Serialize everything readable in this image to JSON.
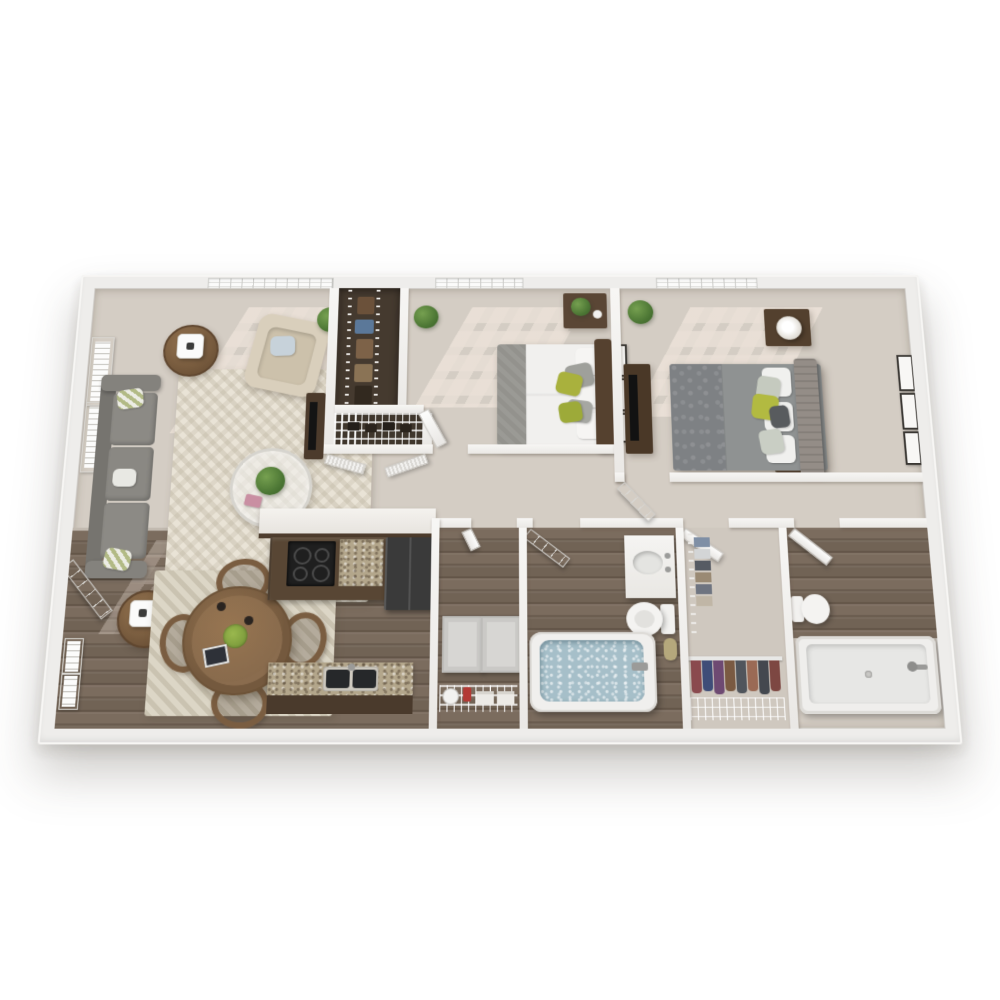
{
  "image": {
    "kind": "3d-floor-plan-render",
    "title": "Two bedroom two bath apartment 3D floor plan",
    "background": "#ffffff"
  },
  "palette": {
    "wall_white": "#f3f2f0",
    "carpet": "#d3ccc3",
    "hardwood": "#75675a",
    "rug_cream": "#e9e3d6",
    "sofa_gray": "#85837f",
    "armchair_cream": "#d9cfbc",
    "accent_green": "#a9b13d",
    "dark_wood": "#55412f",
    "cabinet_brown": "#584634",
    "granite_tan": "#b3a68b",
    "tub_water": "#a6bfc9",
    "appliance_black": "#1f1f1f"
  },
  "apartment": {
    "label": "2 Bedroom / 2 Bath",
    "rooms": [
      {
        "id": "living-room",
        "name": "Living Room",
        "floor": "carpet",
        "furniture": [
          "gray sofa with green pillows",
          "two cream armchairs",
          "round glass coffee table with plant",
          "two round wood side tables with lamps",
          "chevron area rug",
          "tv console",
          "wall art",
          "window"
        ]
      },
      {
        "id": "dining-area",
        "name": "Dining Area",
        "floor": "hardwood",
        "furniture": [
          "round wood dining table",
          "four wood chairs",
          "cream rug",
          "fruit bowl",
          "tablet",
          "entry door",
          "wall art"
        ]
      },
      {
        "id": "kitchen",
        "name": "Kitchen",
        "floor": "hardwood",
        "furniture": [
          "breakfast bar counter",
          "dark brown cabinets",
          "black range",
          "granite countertop",
          "refrigerator",
          "peninsula with double sink"
        ]
      },
      {
        "id": "hallway",
        "name": "Hallway",
        "floor": "carpet",
        "furniture": []
      },
      {
        "id": "long-closet",
        "name": "Walk-through Closet",
        "floor": "dark",
        "furniture": [
          "wire shelving",
          "hanging clothes",
          "louvered doors"
        ]
      },
      {
        "id": "linen-closet",
        "name": "Linen Closet",
        "floor": "dark",
        "furniture": [
          "wire shelf",
          "shoes"
        ]
      },
      {
        "id": "bedroom-1",
        "name": "Bedroom 1",
        "floor": "carpet",
        "furniture": [
          "queen bed with white duvet and green pillows",
          "dark wood headboard",
          "nightstand with plant",
          "wall art frames",
          "corner plants",
          "window"
        ]
      },
      {
        "id": "bedroom-2",
        "name": "Bedroom 2",
        "floor": "carpet",
        "furniture": [
          "bed with gray patterned duvet and green accent pillow",
          "tufted headboard",
          "two nightstands with drum lamps",
          "dresser with tv",
          "three wall art frames",
          "corner plant",
          "window"
        ]
      },
      {
        "id": "laundry-closet",
        "name": "Laundry Closet",
        "floor": "hardwood",
        "furniture": [
          "washer",
          "dryer",
          "wire shelf",
          "hamper",
          "detergent",
          "towels"
        ]
      },
      {
        "id": "bathroom-1",
        "name": "Bathroom",
        "floor": "hardwood",
        "furniture": [
          "white vanity with oval sink",
          "toilet",
          "soaking tub with water",
          "towel roll",
          "door"
        ]
      },
      {
        "id": "walk-in-closet",
        "name": "Walk-in Closet",
        "floor": "carpet",
        "furniture": [
          "wire shelving with folded clothes",
          "hanging rod with colorful clothes"
        ]
      },
      {
        "id": "bathroom-2",
        "name": "Bathroom 2",
        "floor": "hardwood",
        "furniture": [
          "toilet",
          "walk-in shower with fixture"
        ]
      }
    ]
  }
}
